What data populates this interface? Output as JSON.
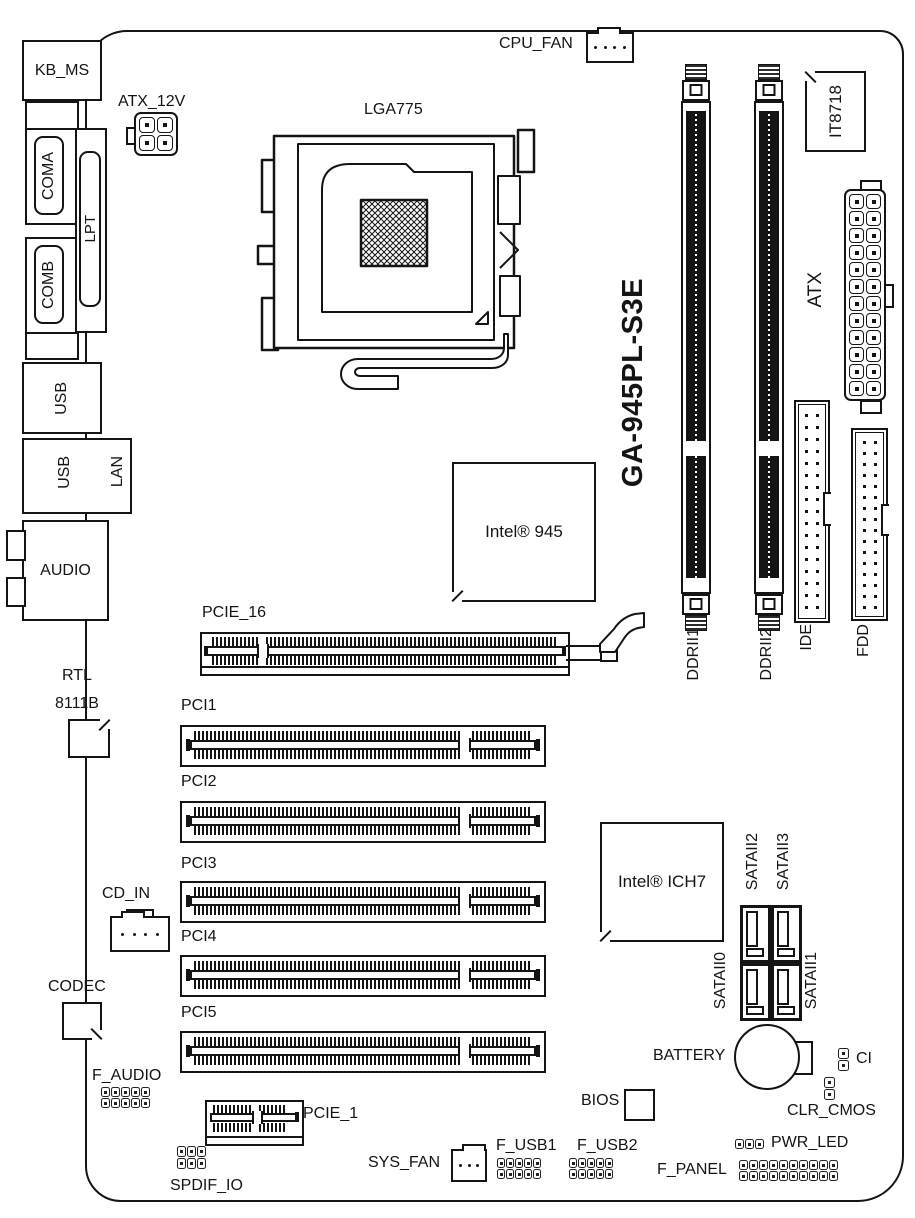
{
  "board": {
    "model": "GA-945PL-S3E"
  },
  "rear_io": {
    "kb_ms": "KB_MS",
    "coma": "COMA",
    "lpt": "LPT",
    "comb": "COMB",
    "usb_top": "USB",
    "usb_mid": "USB",
    "lan": "LAN",
    "audio": "AUDIO"
  },
  "cpu": {
    "socket": "LGA775",
    "fan": "CPU_FAN",
    "power": "ATX_12V"
  },
  "chips": {
    "super_io": "IT8718",
    "northbridge": "Intel® 945",
    "southbridge": "Intel® ICH7",
    "lan_chip_line1": "RTL",
    "lan_chip_line2": "8111B",
    "codec": "CODEC",
    "bios": "BIOS"
  },
  "memory": {
    "ddr1": "DDRII1",
    "ddr2": "DDRII2"
  },
  "power": {
    "atx": "ATX"
  },
  "storage": {
    "ide": "IDE",
    "fdd": "FDD",
    "sata0": "SATAII0",
    "sata1": "SATAII1",
    "sata2": "SATAII2",
    "sata3": "SATAII3"
  },
  "slots": {
    "pcie16": "PCIE_16",
    "pci1": "PCI1",
    "pci2": "PCI2",
    "pci3": "PCI3",
    "pci4": "PCI4",
    "pci5": "PCI5",
    "pcie1": "PCIE_1"
  },
  "headers": {
    "cd_in": "CD_IN",
    "f_audio": "F_AUDIO",
    "spdif_io": "SPDIF_IO",
    "sys_fan": "SYS_FAN",
    "f_usb1": "F_USB1",
    "f_usb2": "F_USB2",
    "battery": "BATTERY",
    "ci": "CI",
    "clr_cmos": "CLR_CMOS",
    "pwr_led": "PWR_LED",
    "f_panel": "F_PANEL"
  }
}
